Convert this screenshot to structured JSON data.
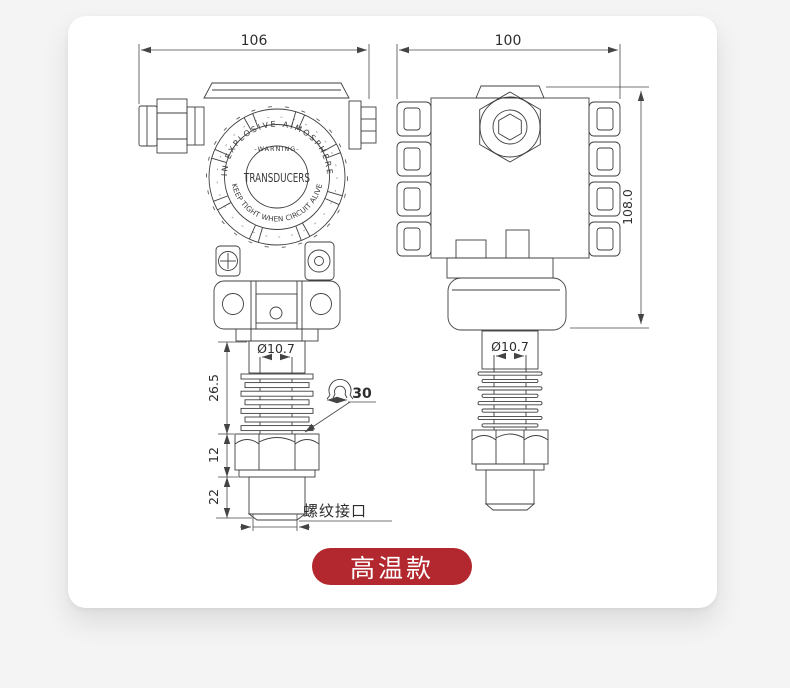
{
  "page": {
    "background": "#f4f4f5",
    "card_background": "#ffffff"
  },
  "drawing": {
    "line_color": "#3f3f3f",
    "front_view": {
      "name": "front-view",
      "width_dim": "106",
      "probe_diameter": "Ø10.7",
      "fins_length_dim": "26.5",
      "hex_length_dim": "12",
      "thread_length_dim": "22",
      "hex_width_dim": "30",
      "thread_port_label": "螺纹接口",
      "face": {
        "arc_top": "IN EXPLOSIVE AIMOSPHERE",
        "warning": "-WARNING-",
        "center": "TRANSDUCERS",
        "arc_bottom": "KEEP TIGHT WHEN CIRCUIT ALIVE"
      }
    },
    "side_view": {
      "name": "side-view",
      "width_dim": "100",
      "height_dim": "108.0",
      "probe_diameter": "Ø10.7"
    }
  },
  "badge": {
    "label": "高温款",
    "background": "#b2282e",
    "text_color": "#ffffff"
  }
}
